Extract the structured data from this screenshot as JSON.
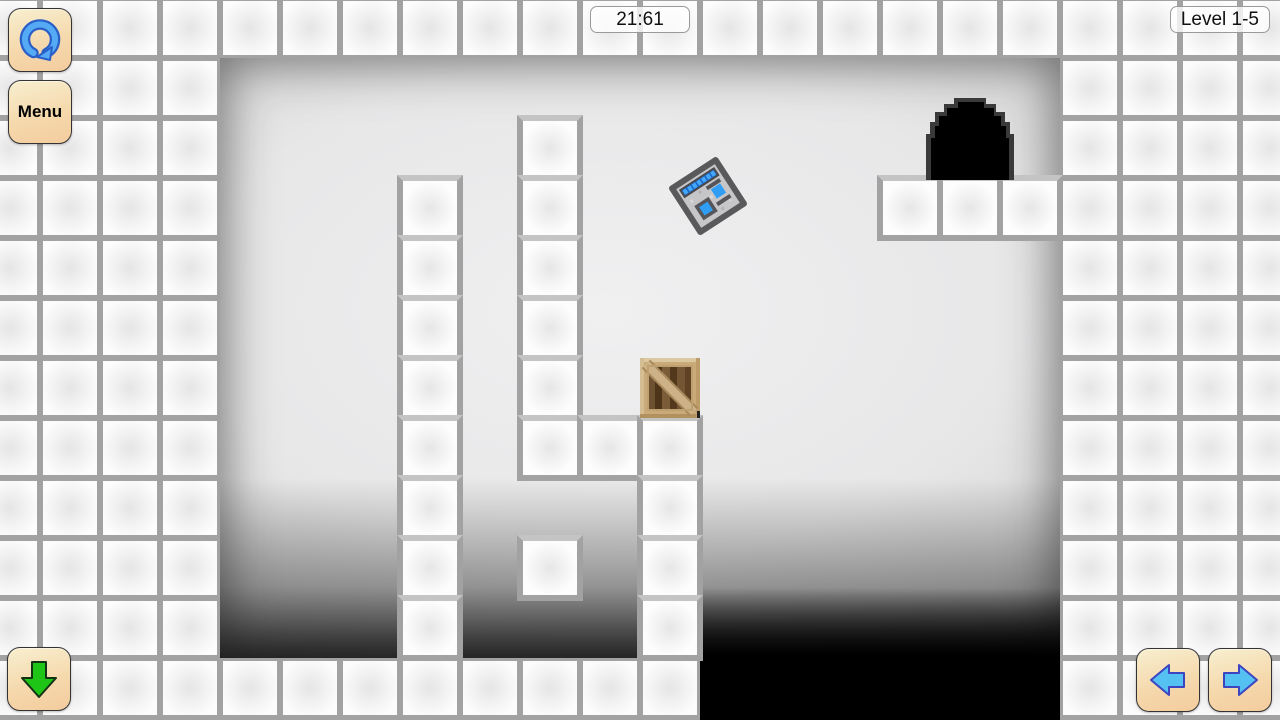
{
  "hud": {
    "timer": "21:61",
    "level": "Level 1-5",
    "menu_label": "Menu"
  },
  "icons": {
    "reset": "reset-circular-arrow-icon",
    "move_down": "green-down-arrow-icon",
    "move_left": "blue-left-arrow-icon",
    "move_right": "blue-right-arrow-icon",
    "player": "robot-face-sprite",
    "box": "wooden-crate-sprite",
    "goal": "black-exit-arch"
  },
  "colors": {
    "button_bg_top": "#f8efd0",
    "button_bg_bottom": "#f4cc9e",
    "button_border": "#333333",
    "badge_bg": "rgba(255,255,255,0.78)",
    "grout_gray": "#a2a2a2",
    "tile_white": "#fbfbfb",
    "reset_arrow_blue": "#54aaf5",
    "move_arrow_blue": "#55c0f2",
    "move_arrow_green": "#1ec516",
    "robot_body_gray": "#c6c6c8",
    "robot_eye_blue": "#2f9ef4",
    "crate_frame_tan": "#c9aa78",
    "crate_plank_brown": "#6e5130",
    "exit_black": "#000000"
  },
  "board": {
    "origin_x": 220,
    "origin_y": 58,
    "cell": 60,
    "cols": 14,
    "rows": 10,
    "tiles": [
      [
        3,
        2
      ],
      [
        3,
        3
      ],
      [
        3,
        4
      ],
      [
        3,
        5
      ],
      [
        3,
        6
      ],
      [
        3,
        7
      ],
      [
        3,
        8
      ],
      [
        3,
        9
      ],
      [
        5,
        1
      ],
      [
        5,
        2
      ],
      [
        5,
        3
      ],
      [
        5,
        4
      ],
      [
        5,
        5
      ],
      [
        5,
        6
      ],
      [
        6,
        6
      ],
      [
        7,
        6
      ],
      [
        7,
        7
      ],
      [
        7,
        8
      ],
      [
        7,
        9
      ],
      [
        5,
        8
      ],
      [
        11,
        2
      ],
      [
        12,
        2
      ],
      [
        13,
        2
      ]
    ],
    "crate": {
      "x": 640,
      "y": 358,
      "w": 60,
      "h": 60
    },
    "robot": {
      "x": 678,
      "y": 166,
      "w": 60,
      "h": 60,
      "rotate": -33
    },
    "exit": {
      "x": 926,
      "y": 94,
      "w": 88,
      "h": 86
    },
    "pit": {
      "x": 700,
      "y": 588,
      "w": 360,
      "h": 132
    }
  }
}
